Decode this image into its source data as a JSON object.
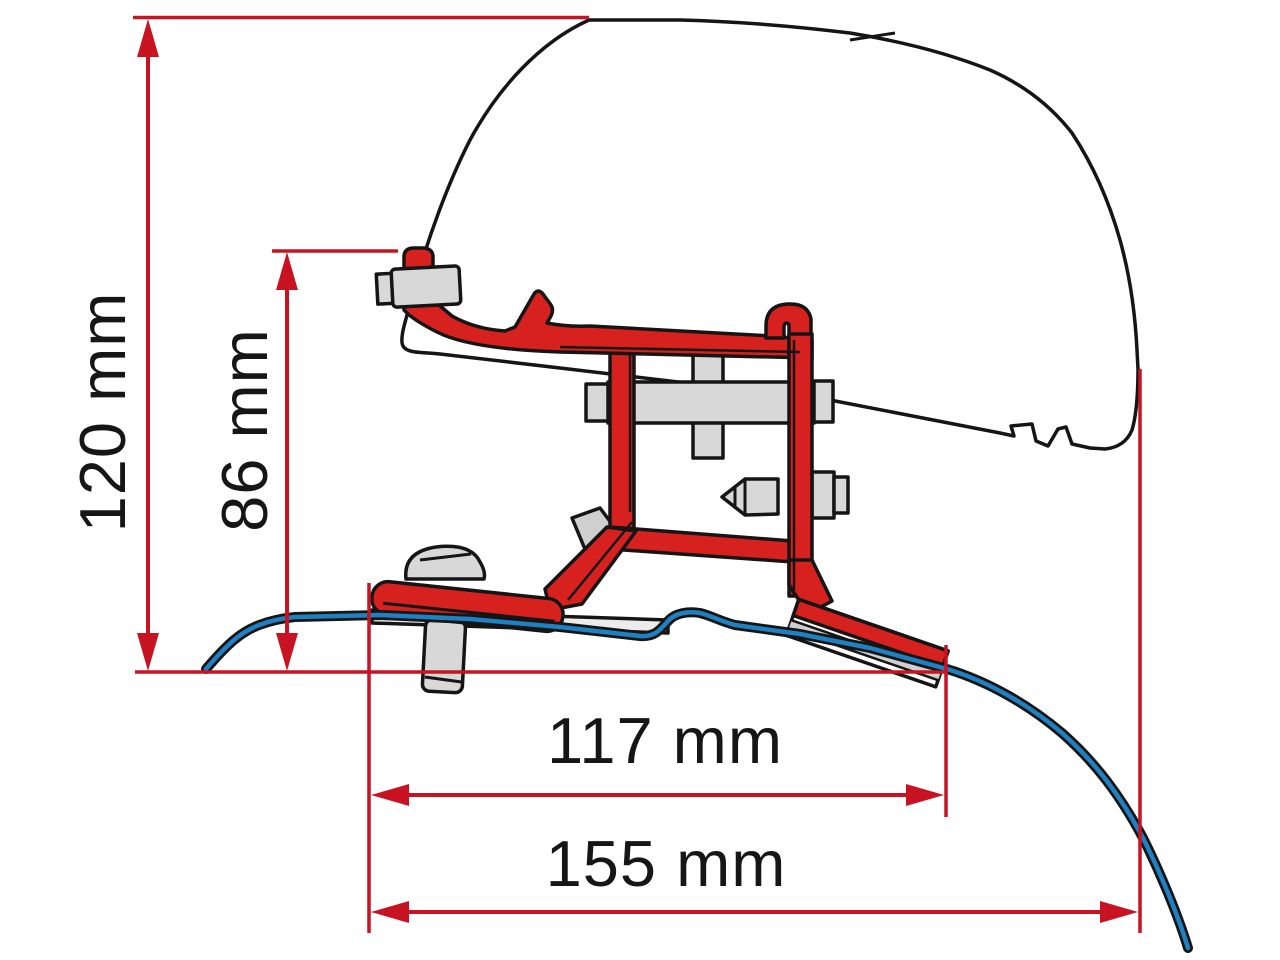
{
  "page": {
    "title": "Awning adapter bracket side-profile technical drawing"
  },
  "diagram": {
    "type": "technical-dimension-drawing",
    "subject": "roof mounting bracket with awning case profile and van roof contour",
    "dimensions": [
      {
        "id": "overall-height",
        "label": "120 mm",
        "value": 120,
        "unit": "mm",
        "orientation": "vertical"
      },
      {
        "id": "bracket-height",
        "label": "86 mm",
        "value": 86,
        "unit": "mm",
        "orientation": "vertical"
      },
      {
        "id": "inner-width",
        "label": "117 mm",
        "value": 117,
        "unit": "mm",
        "orientation": "horizontal"
      },
      {
        "id": "overall-width",
        "label": "155 mm",
        "value": 155,
        "unit": "mm",
        "orientation": "horizontal"
      }
    ],
    "colors": {
      "dimension_red": "#c81322",
      "bracket_red": "#d6211f",
      "roof_line_blue": "#1f80c2",
      "outline_black": "#151515",
      "hardware_gray": "#d8d8d8",
      "background": "#ffffff"
    }
  }
}
